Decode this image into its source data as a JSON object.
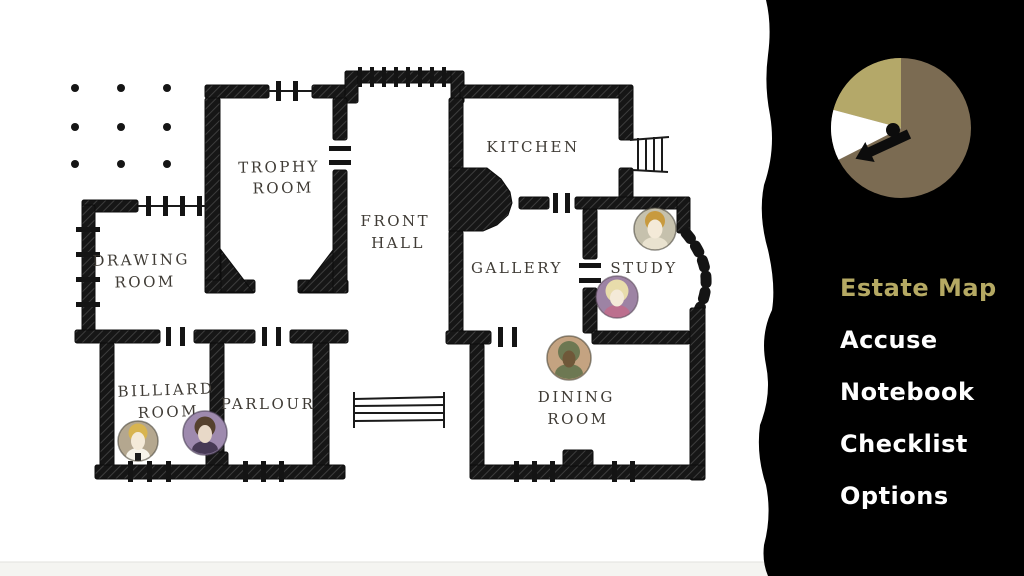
{
  "screen": {
    "title": "Estate Map"
  },
  "map": {
    "paper_color": "#ffffff",
    "ink_color": "#141414",
    "rooms": {
      "trophy": {
        "line1": "TROPHY",
        "line2": "ROOM"
      },
      "front_hall": {
        "line1": "FRONT",
        "line2": "HALL"
      },
      "kitchen": {
        "line1": "KITCHEN"
      },
      "drawing": {
        "line1": "DRAWING",
        "line2": "ROOM"
      },
      "gallery": {
        "line1": "GALLERY"
      },
      "study": {
        "line1": "STUDY"
      },
      "billiard": {
        "line1": "BILLIARD",
        "line2": "ROOM"
      },
      "parlour": {
        "line1": "PARLOUR"
      },
      "dining": {
        "line1": "DINING",
        "line2": "ROOM"
      }
    },
    "tokens": [
      {
        "id": "suspect-study-upper",
        "room": "Study",
        "colors": {
          "bg": "#c6c1ad",
          "hair": "#c89a3e",
          "skin": "#f4ead8",
          "body": "#e9e2cf"
        }
      },
      {
        "id": "suspect-study-lower",
        "room": "Study",
        "colors": {
          "bg": "#9d83a4",
          "hair": "#e8dcab",
          "skin": "#f4ead8",
          "body": "#bc6f8e"
        }
      },
      {
        "id": "suspect-dining",
        "room": "Dining Room",
        "colors": {
          "bg": "#c4a381",
          "hair": "#6d7852",
          "skin": "#6f5839",
          "body": "#6d7852"
        }
      },
      {
        "id": "suspect-billiard-left",
        "room": "Billiard Room",
        "colors": {
          "bg": "#b4a78f",
          "hair": "#d8b44f",
          "skin": "#f4ead8",
          "body": "#f6f3ea"
        }
      },
      {
        "id": "suspect-billiard-right",
        "room": "Billiard Room",
        "colors": {
          "bg": "#9e8aae",
          "hair": "#55412e",
          "skin": "#e8d9c8",
          "body": "#473a55"
        }
      }
    ]
  },
  "sidebar": {
    "bg_color": "#000000",
    "menu": {
      "active_color": "#b5a963",
      "inactive_color": "#ffffff",
      "items": [
        {
          "label": "Estate Map",
          "active": true
        },
        {
          "label": "Accuse"
        },
        {
          "label": "Notebook"
        },
        {
          "label": "Checklist"
        },
        {
          "label": "Options"
        }
      ]
    },
    "timer": {
      "slices": [
        {
          "name": "elapsed",
          "color": "#7b6b52",
          "angle_deg": 243
        },
        {
          "name": "wedge",
          "color": "#b4a869",
          "angle_deg": 75
        },
        {
          "name": "pointer",
          "color": "#ffffff",
          "angle_deg": 42
        }
      ],
      "hand_color": "#0c0c0c"
    }
  }
}
